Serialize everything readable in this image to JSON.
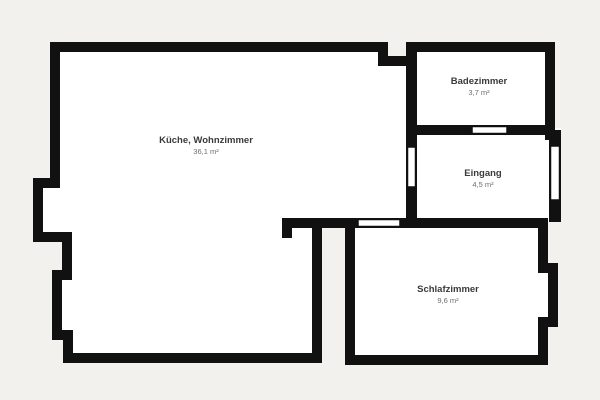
{
  "plan": {
    "title": "apartment-floor-plan",
    "colors": {
      "background": "#f2f1ee",
      "wall": "#111111",
      "room_fill": "#ffffff",
      "room_name_text": "#3a3a3a",
      "room_area_text": "#6e6e6e"
    },
    "rooms": [
      {
        "name": "Küche, Wohnzimmer",
        "area": "36,1 m²"
      },
      {
        "name": "Badezimmer",
        "area": "3,7 m²"
      },
      {
        "name": "Eingang",
        "area": "4,5 m²"
      },
      {
        "name": "Schlafzimmer",
        "area": "9,6 m²"
      }
    ]
  }
}
